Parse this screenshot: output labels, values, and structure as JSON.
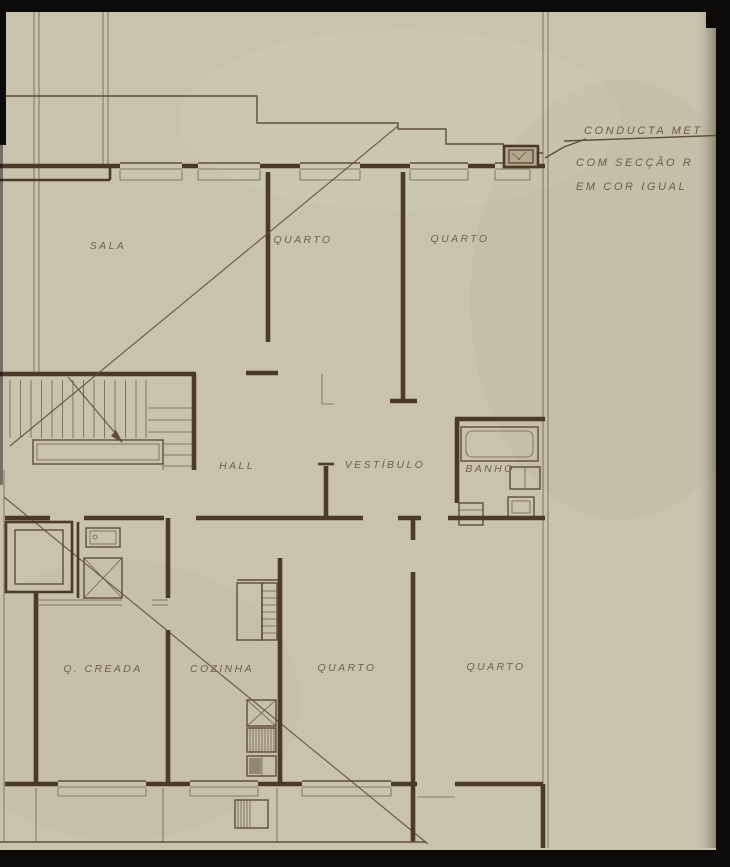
{
  "colors": {
    "paper": "#c9c3ad",
    "ink": "#5f4d38",
    "wall": "#4a3a27",
    "label": "#6a5742",
    "black": "#0c0b09"
  },
  "rooms": {
    "sala": "SALA",
    "quarto_top_left": "QUARTO",
    "quarto_top_right": "QUARTO",
    "hall": "HALL",
    "vestibulo": "VESTÍBULO",
    "banho": "BANHO",
    "quarto_creada": "Q. CREADA",
    "cozinha": "COZINHA",
    "quarto_bottom_left": "QUARTO",
    "quarto_bottom_right": "QUARTO"
  },
  "annotation": {
    "line1": "CONDUCTA MET",
    "line2": "COM SECÇÃO R",
    "line3": "EM COR IGUAL"
  }
}
